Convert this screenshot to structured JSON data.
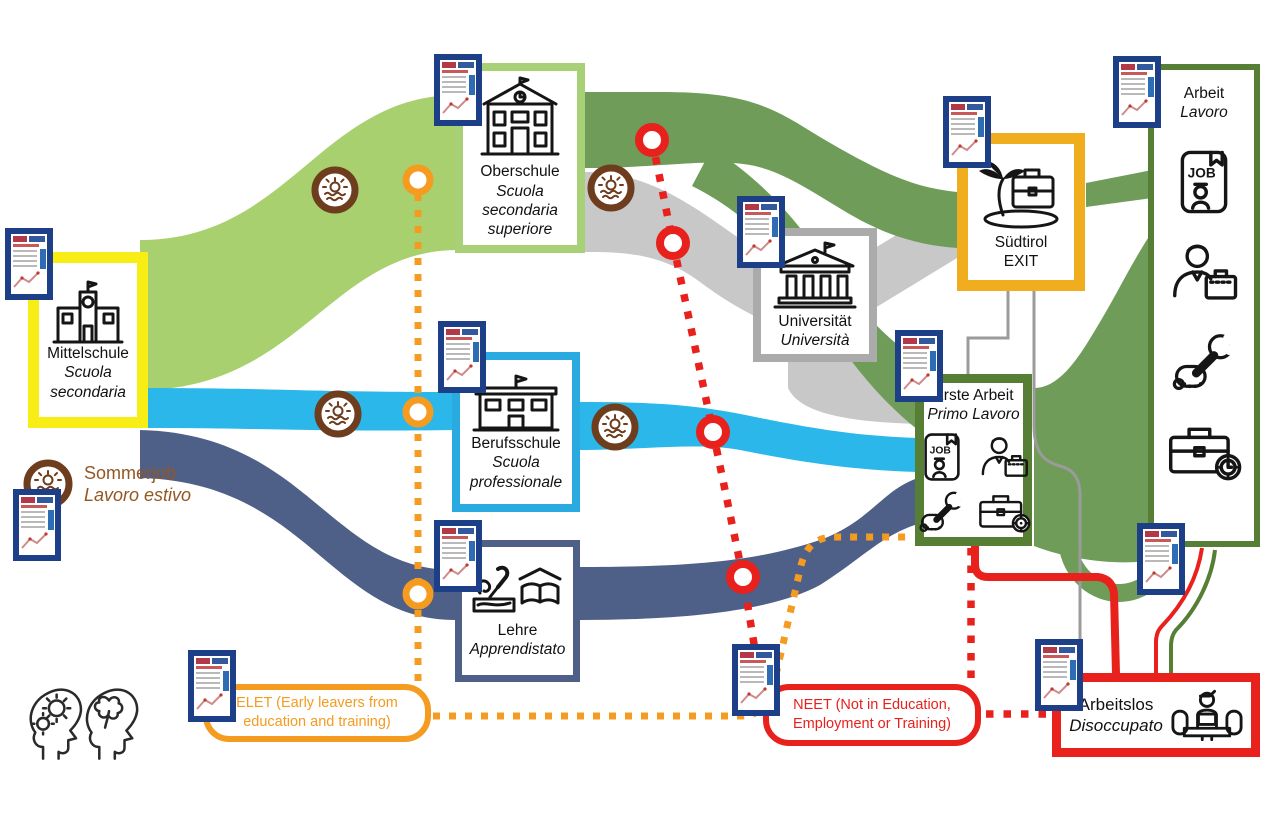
{
  "nodes": {
    "mittelschule": {
      "de": "Mittelschule",
      "it": "Scuola secondaria"
    },
    "oberschule": {
      "de": "Oberschule",
      "it": "Scuola secondaria superiore"
    },
    "berufsschule": {
      "de": "Berufsschule",
      "it": "Scuola professionale"
    },
    "lehre": {
      "de": "Lehre",
      "it": "Apprendistato"
    },
    "universitaet": {
      "de": "Universität",
      "it": "Università"
    },
    "suedtirol_exit": {
      "line1": "Südtirol",
      "line2": "EXIT"
    },
    "erste_arbeit": {
      "de": "Erste Arbeit",
      "it": "Primo Lavoro"
    },
    "arbeit": {
      "de": "Arbeit",
      "it": "Lavoro"
    },
    "arbeitslos": {
      "de": "Arbeitslos",
      "it": "Disoccupato"
    }
  },
  "legend": {
    "sommerjob": {
      "de": "Sommerjob",
      "it": "Lavoro estivo"
    },
    "elet": "ELET (Early leavers from education and training)",
    "neet": "NEET (Not in Education, Employment or Training)"
  },
  "colors": {
    "light_green_band": "#a8d06e",
    "dark_green_band": "#6f9c58",
    "dark_green_border": "#567f35",
    "cyan_band": "#2bb7e9",
    "cyan_border": "#29abe2",
    "slate_band": "#4e5f88",
    "gray_band": "#c8c8c8",
    "gray_border": "#ababab",
    "yellow_border": "#f8ee15",
    "amber_border": "#f0ad1d",
    "orange_dotted": "#f59b20",
    "red": "#e8211d",
    "brown": "#6e3d1d",
    "doc_blue": "#1c3f87"
  },
  "diagram_flows": [
    {
      "from": "Mittelschule",
      "to": "Oberschule",
      "color": "#a8d06e"
    },
    {
      "from": "Mittelschule",
      "to": "Berufsschule",
      "color": "#2bb7e9"
    },
    {
      "from": "Mittelschule",
      "to": "Lehre",
      "color": "#4e5f88"
    },
    {
      "from": "Oberschule",
      "to": "Südtirol EXIT",
      "color": "#6f9c58"
    },
    {
      "from": "Oberschule",
      "to": "Universität",
      "color": "#c8c8c8"
    },
    {
      "from": "Oberschule",
      "to": "Erste Arbeit",
      "color": "#6f9c58"
    },
    {
      "from": "Universität",
      "to": "Südtirol EXIT",
      "color": "#c8c8c8"
    },
    {
      "from": "Universität",
      "to": "Erste Arbeit",
      "color": "#c8c8c8"
    },
    {
      "from": "Berufsschule",
      "to": "Erste Arbeit",
      "color": "#2bb7e9"
    },
    {
      "from": "Lehre",
      "to": "Erste Arbeit",
      "color": "#4e5f88"
    },
    {
      "from": "Erste Arbeit",
      "to": "Arbeit",
      "color": "#6f9c58"
    },
    {
      "from": "Südtirol EXIT",
      "to": "Arbeit",
      "color": "#6f9c58"
    },
    {
      "from": "Südtirol EXIT",
      "to": "Erste Arbeit",
      "color": "#999999"
    },
    {
      "from": "Südtirol EXIT",
      "to": "Arbeitslos",
      "color": "#999999"
    },
    {
      "from": "Erste Arbeit",
      "to": "Arbeitslos",
      "color": "#e8211d"
    },
    {
      "from": "Arbeit",
      "to": "Arbeitslos",
      "color": "#e8211d"
    },
    {
      "from": "Arbeitslos",
      "to": "Arbeit",
      "color": "#6f9c58"
    }
  ]
}
